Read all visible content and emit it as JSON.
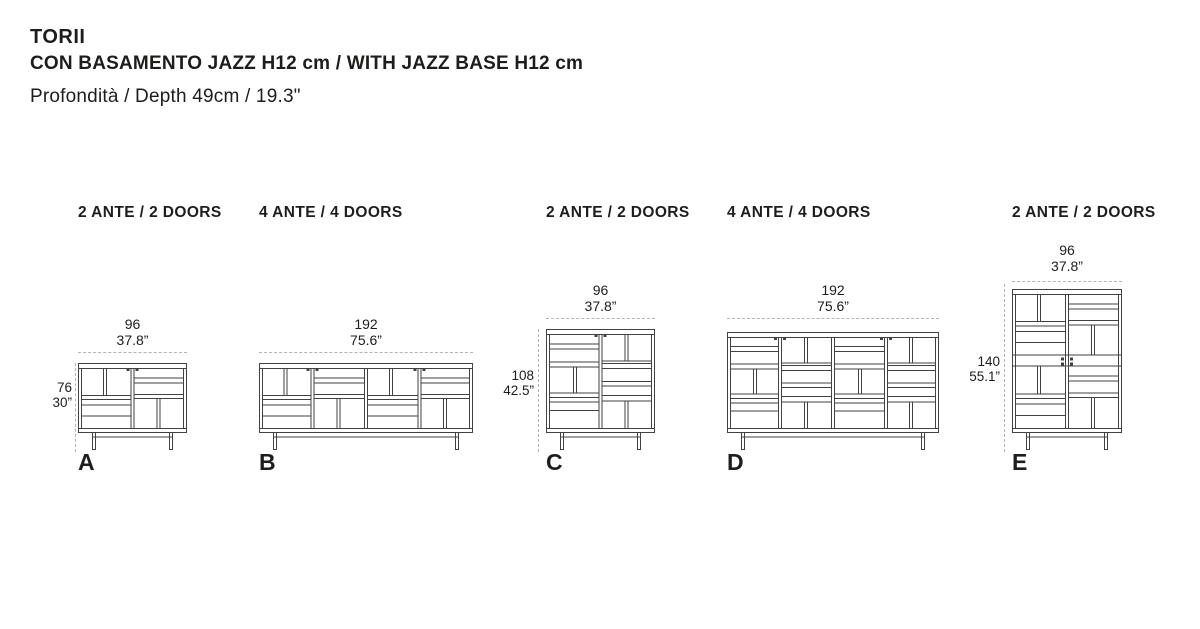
{
  "header": {
    "title": "TORII",
    "subtitle": "CON BASAMENTO JAZZ H12 cm / WITH JAZZ BASE H12 cm",
    "depth_line": "Profondità / Depth 49cm / 19.3\""
  },
  "colors": {
    "text": "#1d1d1b",
    "line": "#424242",
    "dash": "#b3b3b3",
    "background": "#ffffff"
  },
  "cabinets": [
    {
      "id": "a",
      "label": "A",
      "doors_label": "2 ANTE / 2 DOORS",
      "width_cm": "96",
      "width_in": "37.8”",
      "height_cm": "76",
      "height_in": "30”"
    },
    {
      "id": "b",
      "label": "B",
      "doors_label": "4 ANTE / 4 DOORS",
      "width_cm": "192",
      "width_in": "75.6”"
    },
    {
      "id": "c",
      "label": "C",
      "doors_label": "2 ANTE / 2 DOORS",
      "width_cm": "96",
      "width_in": "37.8”",
      "height_cm": "108",
      "height_in": "42.5”"
    },
    {
      "id": "d",
      "label": "D",
      "doors_label": "4 ANTE / 4 DOORS",
      "width_cm": "192",
      "width_in": "75.6”"
    },
    {
      "id": "e",
      "label": "E",
      "doors_label": "2 ANTE / 2 DOORS",
      "width_cm": "96",
      "width_in": "37.8”",
      "height_cm": "140",
      "height_in": "55.1”"
    }
  ]
}
